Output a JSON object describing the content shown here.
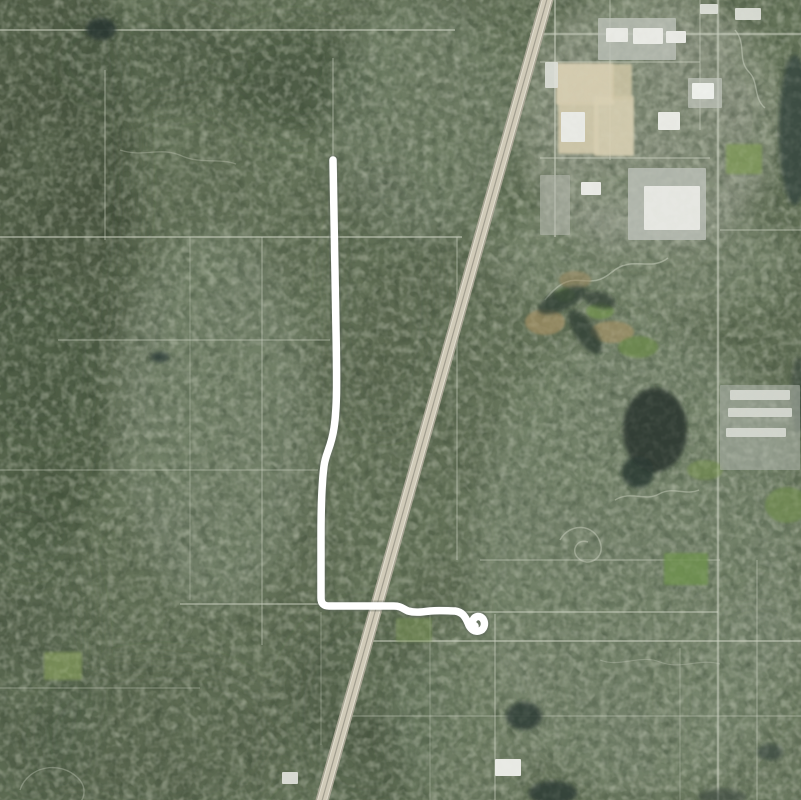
{
  "map": {
    "kind": "satellite-aerial-imagery-with-gps-track",
    "background_color": "#5f6c54",
    "route": {
      "color": "#ffffff",
      "stroke_width": 7.5,
      "halo_color": "rgba(88,98,88,0.35)",
      "halo_width": 11,
      "start": [
        333,
        160
      ],
      "end": [
        475,
        626
      ],
      "path": "M333,160 C334,210 335,270 336,330 C337,385 337,408 334,428 C331,448 326,452 324,466 C322,482 321,505 321,535 L321,598 Q321,606 329,606 L394,606 C401,606 403,609 408,611 C415,613 422,612 430,611 C440,610 448,611 455,611 C462,612 465,616 468,623 C470,629 474,632 479,631 C484,630 486,624 483,619 C480,615 475,616 473,620 C472,623 473,625 475,626"
    },
    "highway": {
      "path": "M549,-8 L320,808",
      "base_color": "#aaa696",
      "base_width": 13,
      "surface_color": "#d0cab8",
      "surface_width": 9.5,
      "median_color": "rgba(150,146,132,0.8)",
      "median_width": 1.2,
      "edge_color": "rgba(242,240,228,0.55)",
      "edge_width": 1,
      "edge_paths": [
        "M553.3,-6.8 L324.3,809.2",
        "M544.7,-9.2 L315.7,806.8"
      ]
    },
    "roads": {
      "color": "#ccd1c2",
      "format_h": "[x1, y, x2, width, opacity]",
      "horizontal": [
        [
          0,
          30,
          455,
          2,
          0.5
        ],
        [
          530,
          34,
          801,
          2.5,
          0.55
        ],
        [
          0,
          237,
          462,
          2,
          0.5
        ],
        [
          58,
          340,
          330,
          1.5,
          0.4
        ],
        [
          0,
          470,
          318,
          1.5,
          0.35
        ],
        [
          180,
          604,
          330,
          2,
          0.45
        ],
        [
          460,
          612,
          718,
          2,
          0.45
        ],
        [
          360,
          641,
          801,
          2,
          0.5
        ],
        [
          480,
          560,
          720,
          1.5,
          0.4
        ],
        [
          340,
          716,
          801,
          1.5,
          0.35
        ],
        [
          0,
          688,
          200,
          1.5,
          0.3
        ],
        [
          540,
          62,
          700,
          1.5,
          0.45
        ],
        [
          540,
          158,
          710,
          1.5,
          0.5
        ],
        [
          720,
          230,
          801,
          1.5,
          0.45
        ]
      ],
      "format_v": "[x, y1, y2, width, opacity]",
      "vertical": [
        [
          105,
          70,
          240,
          1.5,
          0.4
        ],
        [
          190,
          237,
          600,
          1.2,
          0.3
        ],
        [
          262,
          237,
          645,
          1.5,
          0.4
        ],
        [
          333,
          58,
          160,
          1.5,
          0.4
        ],
        [
          321,
          612,
          745,
          1.2,
          0.3
        ],
        [
          457,
          237,
          560,
          1.5,
          0.4
        ],
        [
          555,
          0,
          237,
          2,
          0.5
        ],
        [
          610,
          0,
          160,
          1.5,
          0.4
        ],
        [
          700,
          0,
          130,
          1.5,
          0.4
        ],
        [
          718,
          0,
          800,
          2.5,
          0.55
        ],
        [
          495,
          614,
          800,
          1.5,
          0.45
        ],
        [
          430,
          614,
          800,
          1.2,
          0.3
        ],
        [
          757,
          560,
          800,
          1.5,
          0.35
        ],
        [
          680,
          648,
          800,
          1.2,
          0.3
        ]
      ],
      "curvy": [
        {
          "d": "M545,300 C575,262 585,295 612,272 C632,255 650,272 668,258",
          "w": 1.5,
          "op": 0.5
        },
        {
          "d": "M560,540 c10,-18 34,-16 40,2 c6,16 -12,26 -22,16 c-8,-8 0,-20 10,-16",
          "w": 1.5,
          "op": 0.45
        },
        {
          "d": "M615,500 c16,-10 30,2 44,-6 c14,-8 26,2 40,-4",
          "w": 1.4,
          "op": 0.45
        },
        {
          "d": "M735,30 c12,14 2,30 14,42 c10,10 4,26 16,36",
          "w": 1.4,
          "op": 0.5
        },
        {
          "d": "M120,150 c24,8 40,-4 62,6 c18,8 38,2 54,8",
          "w": 1.3,
          "op": 0.32
        },
        {
          "d": "M20,790 c8,-24 40,-30 58,-12 c14,14 2,34 -18,34",
          "w": 1.4,
          "op": 0.35
        },
        {
          "d": "M600,660 c20,8 40,-6 60,2 c20,8 40,-4 60,2",
          "w": 1.2,
          "op": 0.3
        }
      ]
    },
    "patches_format": "{cx,cy,rx,ry,fill,op,rot} soft blurred terrain tone zones",
    "patches": [
      {
        "cx": 40,
        "cy": 180,
        "rx": 95,
        "ry": 260,
        "fill": "#42503c",
        "op": 0.9
      },
      {
        "cx": 30,
        "cy": 430,
        "rx": 80,
        "ry": 140,
        "fill": "#47553f",
        "op": 0.8
      },
      {
        "cx": 25,
        "cy": 660,
        "rx": 70,
        "ry": 160,
        "fill": "#4b5942",
        "op": 0.55
      },
      {
        "cx": 295,
        "cy": 80,
        "rx": 75,
        "ry": 55,
        "fill": "#3f4d39",
        "op": 0.8
      },
      {
        "cx": 150,
        "cy": 60,
        "rx": 90,
        "ry": 50,
        "fill": "#49573f",
        "op": 0.6
      },
      {
        "cx": 385,
        "cy": 300,
        "rx": 55,
        "ry": 130,
        "fill": "#4d5b45",
        "op": 0.45
      },
      {
        "cx": 370,
        "cy": 710,
        "rx": 85,
        "ry": 100,
        "fill": "#475541",
        "op": 0.6
      },
      {
        "cx": 160,
        "cy": 740,
        "rx": 120,
        "ry": 80,
        "fill": "#4a5841",
        "op": 0.5
      },
      {
        "cx": 215,
        "cy": 420,
        "rx": 95,
        "ry": 190,
        "fill": "#83907c",
        "op": 0.5
      },
      {
        "cx": 420,
        "cy": 120,
        "rx": 90,
        "ry": 120,
        "fill": "#7e8b76",
        "op": 0.45
      },
      {
        "cx": 640,
        "cy": 560,
        "rx": 170,
        "ry": 240,
        "fill": "#87937f",
        "op": 0.5
      },
      {
        "cx": 640,
        "cy": 260,
        "rx": 150,
        "ry": 60,
        "fill": "#8b9682",
        "op": 0.5
      },
      {
        "cx": 470,
        "cy": 720,
        "rx": 80,
        "ry": 90,
        "fill": "#808d78",
        "op": 0.45
      },
      {
        "cx": 650,
        "cy": 120,
        "rx": 130,
        "ry": 130,
        "fill": "#a9ada1",
        "op": 0.55
      },
      {
        "cx": 760,
        "cy": 700,
        "rx": 90,
        "ry": 110,
        "fill": "#7f8c77",
        "op": 0.4
      }
    ],
    "fields_format": "bright green fields / tan clearings / beige industrial lots",
    "fields": [
      {
        "shape": "rect",
        "x": 556,
        "y": 63,
        "w": 58,
        "h": 42,
        "fill": "#d8cfb2",
        "op": 0.95
      },
      {
        "shape": "rect",
        "x": 558,
        "y": 102,
        "w": 40,
        "h": 52,
        "fill": "#d4cbad",
        "op": 0.9
      },
      {
        "shape": "rect",
        "x": 594,
        "y": 96,
        "w": 40,
        "h": 60,
        "fill": "#d8cfb2",
        "op": 0.9
      },
      {
        "shape": "rect",
        "x": 612,
        "y": 64,
        "w": 20,
        "h": 36,
        "fill": "#cfc5a6",
        "op": 0.85
      },
      {
        "shape": "ellipse",
        "cx": 545,
        "cy": 322,
        "rx": 20,
        "ry": 13,
        "fill": "#9f8d63",
        "op": 0.75
      },
      {
        "shape": "ellipse",
        "cx": 612,
        "cy": 332,
        "rx": 22,
        "ry": 11,
        "fill": "#a39166",
        "op": 0.7
      },
      {
        "shape": "ellipse",
        "cx": 575,
        "cy": 280,
        "rx": 16,
        "ry": 9,
        "fill": "#99885f",
        "op": 0.6
      },
      {
        "shape": "ellipse",
        "cx": 600,
        "cy": 311,
        "rx": 14,
        "ry": 8,
        "fill": "#72904f",
        "op": 0.8
      },
      {
        "shape": "ellipse",
        "cx": 638,
        "cy": 347,
        "rx": 20,
        "ry": 11,
        "fill": "#6d8a4c",
        "op": 0.8
      },
      {
        "shape": "ellipse",
        "cx": 565,
        "cy": 295,
        "rx": 10,
        "ry": 7,
        "fill": "#779553",
        "op": 0.7
      },
      {
        "shape": "rect",
        "x": 726,
        "y": 144,
        "w": 36,
        "h": 30,
        "fill": "#7d9a55",
        "op": 0.75
      },
      {
        "shape": "ellipse",
        "cx": 787,
        "cy": 505,
        "rx": 22,
        "ry": 18,
        "fill": "#6f8c4e",
        "op": 0.7
      },
      {
        "shape": "rect",
        "x": 664,
        "y": 553,
        "w": 44,
        "h": 32,
        "fill": "#6f9050",
        "op": 0.85
      },
      {
        "shape": "rect",
        "x": 44,
        "y": 652,
        "w": 38,
        "h": 28,
        "fill": "#8aa35e",
        "op": 0.6
      },
      {
        "shape": "rect",
        "x": 396,
        "y": 618,
        "w": 36,
        "h": 24,
        "fill": "#7a9355",
        "op": 0.55
      },
      {
        "shape": "ellipse",
        "cx": 705,
        "cy": 470,
        "rx": 18,
        "ry": 10,
        "fill": "#748f50",
        "op": 0.6
      }
    ],
    "ponds_format": "dark water bodies {cx,cy,rx,ry,rot?}",
    "ponds": [
      {
        "cx": 101,
        "cy": 29,
        "rx": 15,
        "ry": 11,
        "fill": "#2d3a32",
        "op": 0.95
      },
      {
        "cx": 160,
        "cy": 357,
        "rx": 9,
        "ry": 5,
        "fill": "#31403a",
        "op": 0.9
      },
      {
        "cx": 562,
        "cy": 300,
        "rx": 26,
        "ry": 10,
        "rot": -25,
        "fill": "#2f3d35",
        "op": 0.8
      },
      {
        "cx": 585,
        "cy": 332,
        "rx": 10,
        "ry": 26,
        "rot": -35,
        "fill": "#2f3d35",
        "op": 0.8
      },
      {
        "cx": 600,
        "cy": 300,
        "rx": 16,
        "ry": 8,
        "rot": 15,
        "fill": "#2f3d35",
        "op": 0.7
      },
      {
        "cx": 655,
        "cy": 430,
        "rx": 32,
        "ry": 42,
        "fill": "#2b3831",
        "op": 0.9
      },
      {
        "cx": 638,
        "cy": 472,
        "rx": 16,
        "ry": 16,
        "fill": "#2b3831",
        "op": 0.85
      },
      {
        "cx": 795,
        "cy": 130,
        "rx": 16,
        "ry": 75,
        "fill": "#36453d",
        "op": 0.8
      },
      {
        "cx": 799,
        "cy": 395,
        "rx": 8,
        "ry": 38,
        "fill": "#36453d",
        "op": 0.6
      },
      {
        "cx": 524,
        "cy": 716,
        "rx": 18,
        "ry": 14,
        "fill": "#2e3c35",
        "op": 0.85
      },
      {
        "cx": 553,
        "cy": 793,
        "rx": 24,
        "ry": 12,
        "fill": "#2e3c35",
        "op": 0.85
      },
      {
        "cx": 770,
        "cy": 752,
        "rx": 13,
        "ry": 8,
        "fill": "#39473e",
        "op": 0.7
      },
      {
        "cx": 722,
        "cy": 797,
        "rx": 24,
        "ry": 8,
        "fill": "#3a4a40",
        "op": 0.6
      }
    ],
    "buildings_format": "white/gray industrial & commercial structures {x,y,w,h}",
    "buildings": [
      {
        "x": 598,
        "y": 18,
        "w": 78,
        "h": 42,
        "fill": "#bcc0b8",
        "op": 0.8
      },
      {
        "x": 628,
        "y": 168,
        "w": 78,
        "h": 72,
        "fill": "#b9bdb5",
        "op": 0.85
      },
      {
        "x": 720,
        "y": 385,
        "w": 80,
        "h": 85,
        "fill": "#a9afa5",
        "op": 0.6
      },
      {
        "x": 540,
        "y": 175,
        "w": 30,
        "h": 60,
        "fill": "#b4b8ae",
        "op": 0.6
      },
      {
        "x": 688,
        "y": 78,
        "w": 34,
        "h": 30,
        "fill": "#c0c4bc",
        "op": 0.7
      },
      {
        "x": 633,
        "y": 28,
        "w": 30,
        "h": 16,
        "fill": "#e9eae5",
        "op": 1
      },
      {
        "x": 666,
        "y": 31,
        "w": 20,
        "h": 12,
        "fill": "#e9eae5",
        "op": 1
      },
      {
        "x": 606,
        "y": 28,
        "w": 22,
        "h": 14,
        "fill": "#e9eae5",
        "op": 1
      },
      {
        "x": 561,
        "y": 112,
        "w": 24,
        "h": 30,
        "fill": "#e9eae5",
        "op": 1
      },
      {
        "x": 658,
        "y": 112,
        "w": 22,
        "h": 18,
        "fill": "#e9eae5",
        "op": 1
      },
      {
        "x": 692,
        "y": 83,
        "w": 22,
        "h": 16,
        "fill": "#eef0ec",
        "op": 1
      },
      {
        "x": 644,
        "y": 186,
        "w": 56,
        "h": 44,
        "fill": "#e6e7e2",
        "op": 1
      },
      {
        "x": 581,
        "y": 182,
        "w": 20,
        "h": 13,
        "fill": "#e9eae5",
        "op": 1
      },
      {
        "x": 735,
        "y": 8,
        "w": 26,
        "h": 12,
        "fill": "#e2e4de",
        "op": 0.9
      },
      {
        "x": 700,
        "y": 4,
        "w": 18,
        "h": 10,
        "fill": "#e2e4de",
        "op": 0.9
      },
      {
        "x": 545,
        "y": 62,
        "w": 13,
        "h": 26,
        "fill": "#dfe1da",
        "op": 0.9
      },
      {
        "x": 730,
        "y": 390,
        "w": 60,
        "h": 10,
        "fill": "#d8dbd4",
        "op": 0.9
      },
      {
        "x": 728,
        "y": 408,
        "w": 64,
        "h": 9,
        "fill": "#d8dbd4",
        "op": 0.9
      },
      {
        "x": 726,
        "y": 428,
        "w": 60,
        "h": 9,
        "fill": "#d8dbd4",
        "op": 0.9
      },
      {
        "x": 495,
        "y": 759,
        "w": 26,
        "h": 17,
        "fill": "#e9eae5",
        "op": 1
      },
      {
        "x": 282,
        "y": 772,
        "w": 16,
        "h": 12,
        "fill": "#e4e6e0",
        "op": 0.9
      }
    ]
  }
}
